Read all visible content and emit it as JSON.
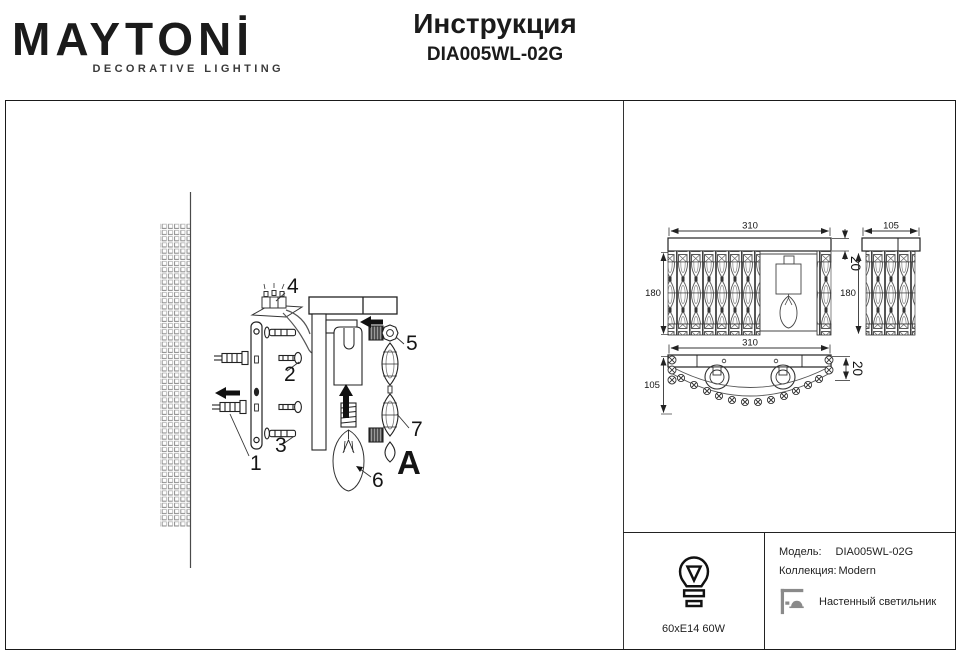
{
  "header": {
    "brand": "MAYTONİ",
    "brand_sub": "DECORATIVE LIGHTING",
    "title": "Инструкция",
    "model": "DIA005WL-02G"
  },
  "assembly": {
    "labels": [
      "1",
      "2",
      "3",
      "4",
      "5",
      "6",
      "7"
    ],
    "detail_label": "A"
  },
  "dimensions": {
    "front": {
      "width": "310",
      "depth_top": "20",
      "height": "180"
    },
    "side": {
      "width": "105",
      "height": "180"
    },
    "bottom": {
      "width": "310",
      "height_bar": "20",
      "depth": "105"
    }
  },
  "info": {
    "bulb_spec": "60xE14 60W",
    "model_label": "Модель:",
    "model_value": "DIA005WL-02G",
    "collection_label": "Коллекция:",
    "collection_value": "Modern",
    "type_label": "Настенный светильник"
  },
  "colors": {
    "ink": "#1b1b1b",
    "icon_gray": "#8a8a8a"
  }
}
